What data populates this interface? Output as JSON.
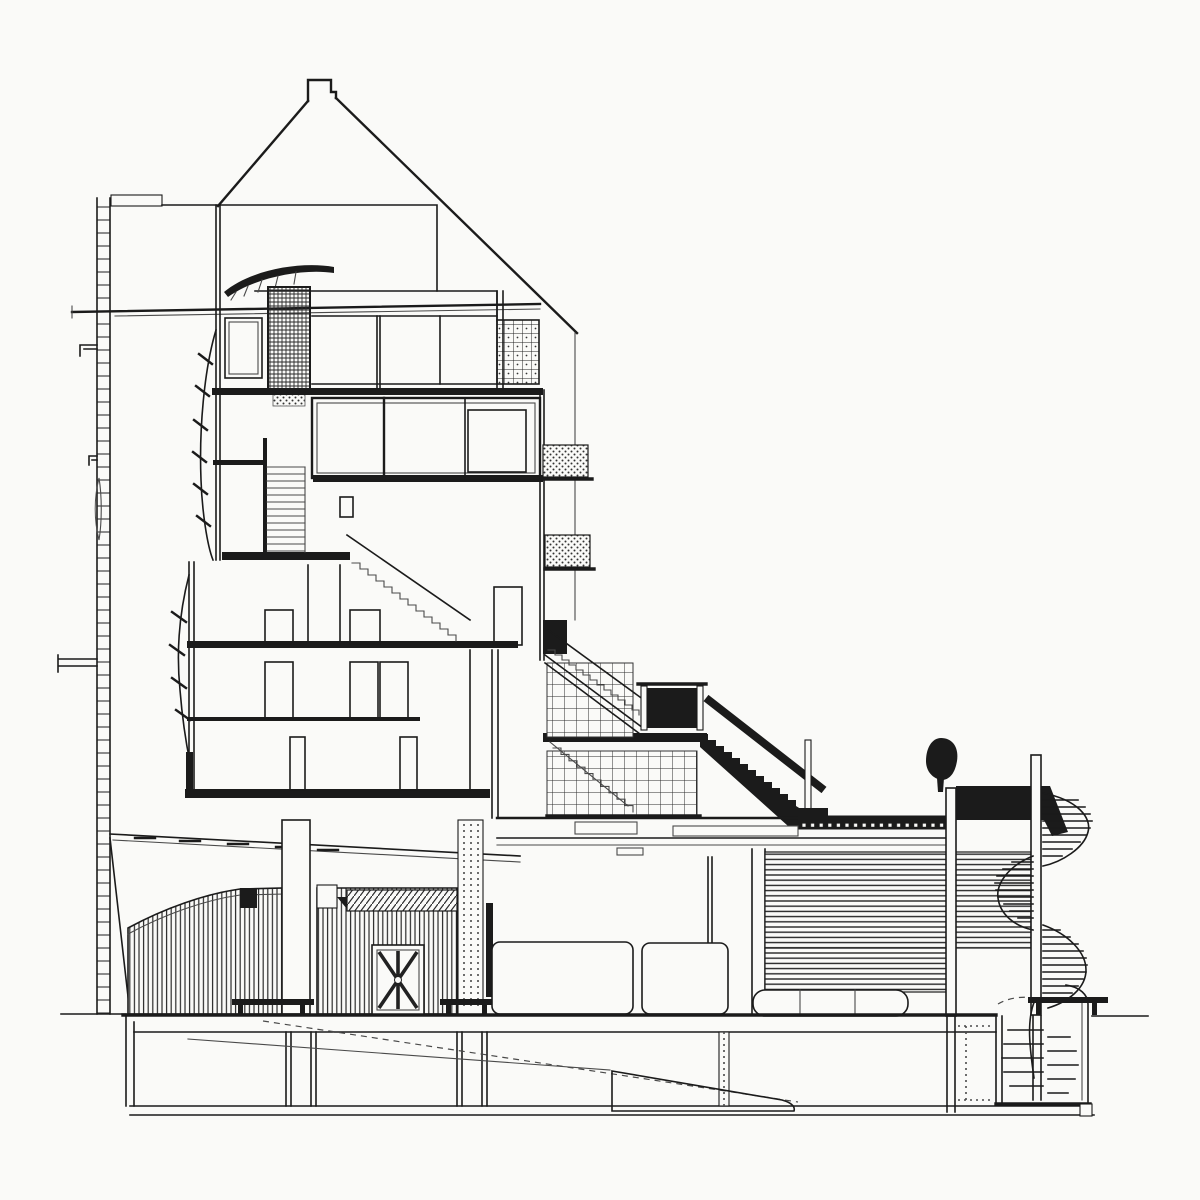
{
  "meta": {
    "kind": "architectural-section-drawing",
    "content": "black-ink building cross-section: multi-storey gabled tower at left, long diagonal stair and escalator descending right over a glazed grid wall, slatted lower hall with sunburst fan window, louvered wing, rooftop tree, spiral staircase at far right, basement below ground line"
  },
  "palette": {
    "paper": "#fafaf8",
    "ink": "#1b1b1b",
    "line_gray": "#4a4a4a",
    "soft_gray": "#8d8d8d"
  }
}
